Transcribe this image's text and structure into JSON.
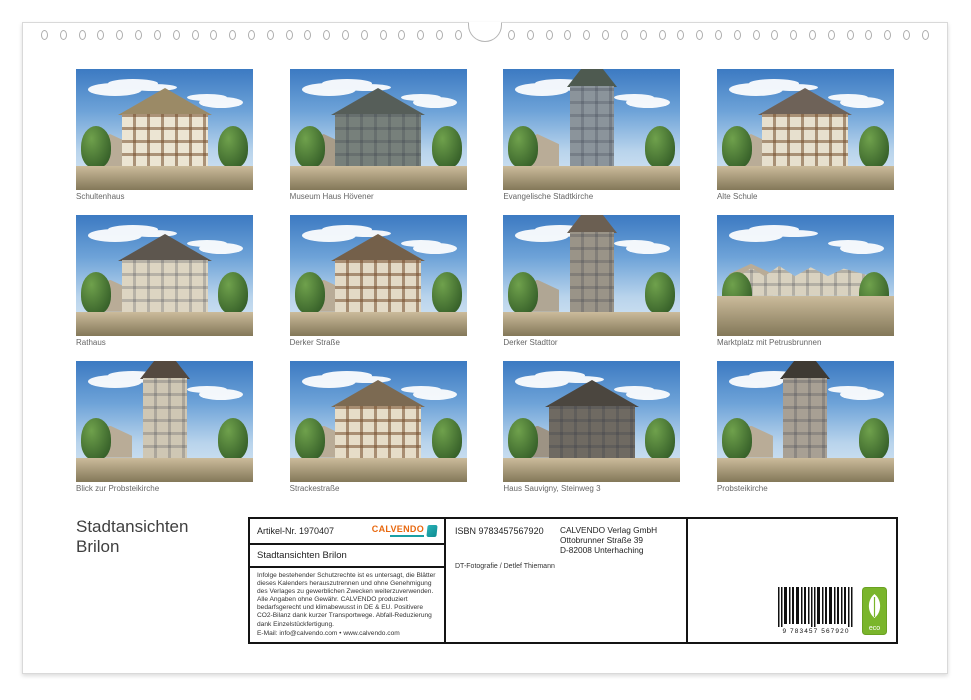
{
  "page_title": {
    "line1": "Stadtansichten",
    "line2": "Brilon"
  },
  "gallery": {
    "items": [
      {
        "caption": "Schultenhaus"
      },
      {
        "caption": "Museum Haus Hövener"
      },
      {
        "caption": "Evangelische Stadtkirche"
      },
      {
        "caption": "Alte Schule"
      },
      {
        "caption": "Rathaus"
      },
      {
        "caption": "Derker Straße"
      },
      {
        "caption": "Derker Stadttor"
      },
      {
        "caption": "Marktplatz mit Petrusbrunnen"
      },
      {
        "caption": "Blick zur Probsteikirche"
      },
      {
        "caption": "Strackestraße"
      },
      {
        "caption": "Haus Sauvigny, Steinweg 3"
      },
      {
        "caption": "Probsteikirche"
      }
    ]
  },
  "info_box": {
    "article_no": "Artikel-Nr. 1970407",
    "brand_name": "CALVENDO",
    "product_title": "Stadtansichten Brilon",
    "legal_text": "Infolge bestehender Schutzrechte ist es untersagt, die Blätter dieses Kalenders herauszutrennen und ohne Genehmigung des Verlages zu gewerblichen Zwecken weiterzuverwenden. Alle Angaben ohne Gewähr. CALVENDO produziert bedarfsgerecht und klimabewusst in DE & EU. Positivere CO2-Bilanz dank kurzer Transportwege. Abfall-Reduzierung dank Einzelstückfertigung.",
    "legal_email": "E-Mail: info@calvendo.com • www.calvendo.com",
    "isbn": "ISBN 9783457567920",
    "publisher": "CALVENDO Verlag GmbH\nOttobrunner Straße 39\nD-82008 Unterhaching",
    "photographer": "DT-Fotografie / Detlef Thiemann",
    "barcode_number": "9 783457 567920",
    "eco_label": "eco"
  },
  "colors": {
    "brand_orange": "#e8680f",
    "brand_teal": "#1aa0a5",
    "eco_green": "#7ab52b",
    "box_border": "#141414"
  }
}
